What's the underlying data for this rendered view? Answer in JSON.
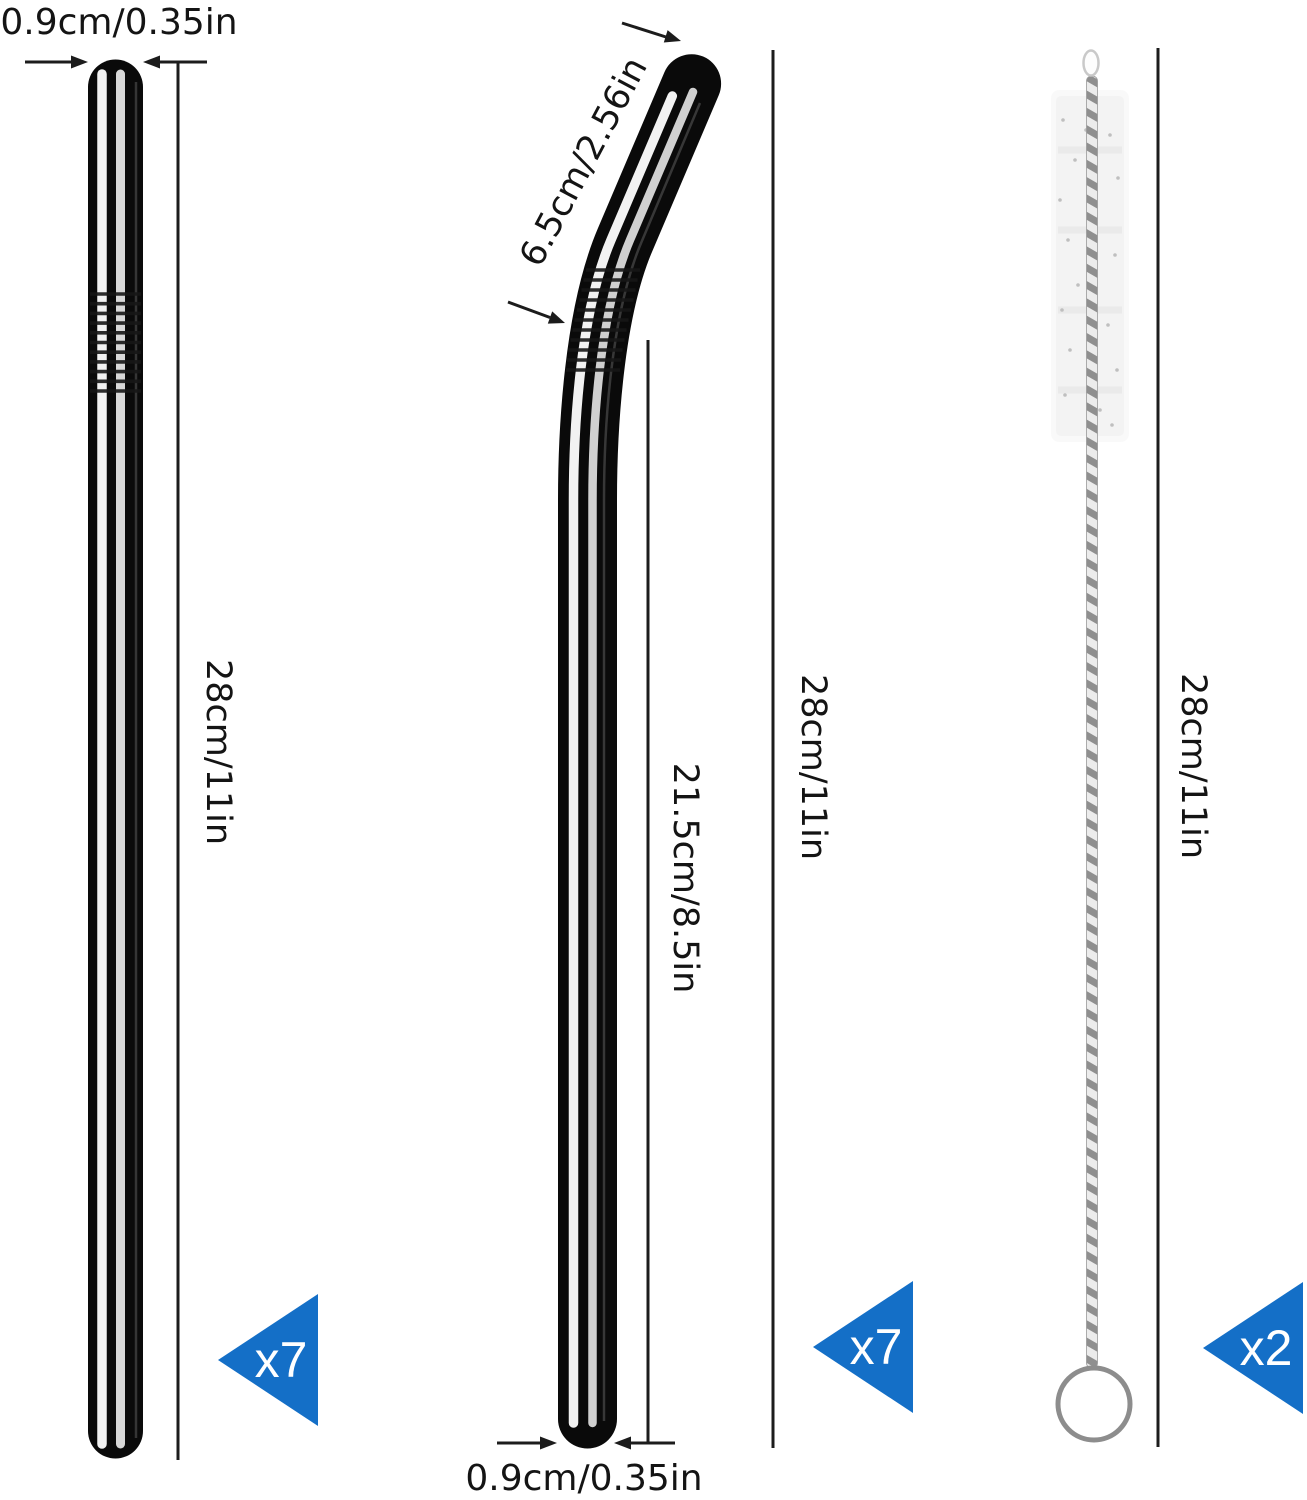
{
  "straight_straw": {
    "diameter_label": "0.9cm/0.35in",
    "length_label": "28cm/11in",
    "count_label": "x7"
  },
  "bent_straw": {
    "bend_length_label": "6.5cm/2.56in",
    "straight_section_label": "21.5cm/8.5in",
    "total_length_label": "28cm/11in",
    "diameter_label": "0.9cm/0.35in",
    "count_label": "x7"
  },
  "cleaning_brush": {
    "length_label": "28cm/11in",
    "count_label": "x2"
  },
  "colors": {
    "count_badge_blue": "#146fc7",
    "dimension_line_black": "#1c1c1c",
    "background_white": "#ffffff"
  }
}
